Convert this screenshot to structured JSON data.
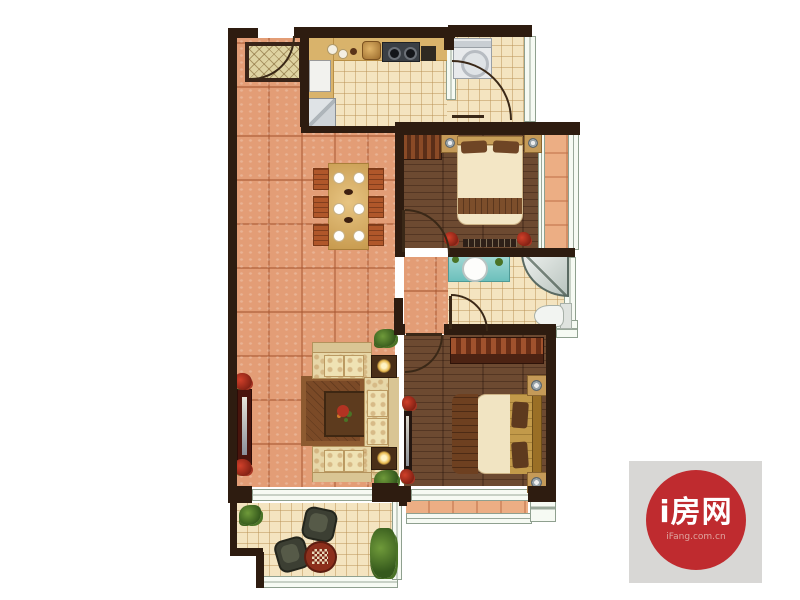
{
  "meta": {
    "type": "apartment-floor-plan-rendering",
    "bedrooms": 2,
    "orientation": "top-down"
  },
  "watermark": {
    "title": "i房网",
    "subtitle": "iFang.com.cn",
    "box_color": "#d8d7d5",
    "circle_color": "#bf2b2f",
    "title_color": "#ffffff",
    "subtitle_color": "#dfa6a0"
  },
  "palette": {
    "wall": "#2e1c10",
    "living_floor_terracotta": "#e39d76",
    "ceramic_tile_floor": "#f4e4c0",
    "hardwood_floor": "#6d4a31",
    "terrace_tile": "#ecae84",
    "window_frame": "#8fa08f",
    "sofa_fabric": "#e7d7a8",
    "bed_linen": "#f3e6c5",
    "bed_runner": "#7c4e2b",
    "vanity_teal": "#6cc0bc",
    "dining_chair": "#b0572a"
  },
  "rooms": [
    {
      "name": "entry",
      "floor": "terracotta",
      "items": [
        "doormat",
        "entry-door"
      ]
    },
    {
      "name": "kitchen",
      "floor": "ceramic-tile",
      "items": [
        "l-shaped-counter",
        "fridge",
        "sink",
        "gas-stove",
        "countertop-dishes"
      ]
    },
    {
      "name": "laundry",
      "floor": "ceramic-tile",
      "items": [
        "washing-machine",
        "door"
      ]
    },
    {
      "name": "living-dining",
      "floor": "terracotta",
      "items": [
        "dining-table",
        "six-chairs",
        "three-piece-sofa-set",
        "rug",
        "coffee-table-with-flowers",
        "two-lamp-side-tables",
        "tv-cabinet",
        "plants"
      ]
    },
    {
      "name": "bedroom-1",
      "floor": "hardwood",
      "items": [
        "double-bed",
        "wardrobe",
        "two-nightstands-with-lamps",
        "low-dresser",
        "flower-pots"
      ]
    },
    {
      "name": "bathroom",
      "floor": "ceramic-tile",
      "items": [
        "vanity-with-round-sink",
        "corner-shower",
        "toilet"
      ]
    },
    {
      "name": "master-bedroom",
      "floor": "hardwood",
      "items": [
        "double-bed",
        "wardrobe",
        "two-nightstands-with-lamps",
        "tv-stand",
        "flower-pots",
        "bay-window"
      ]
    },
    {
      "name": "balcony",
      "floor": "ceramic-tile",
      "items": [
        "two-lounge-chairs",
        "round-chess-table",
        "plants"
      ]
    },
    {
      "name": "side-terrace",
      "floor": "terracotta-tile",
      "items": []
    }
  ]
}
